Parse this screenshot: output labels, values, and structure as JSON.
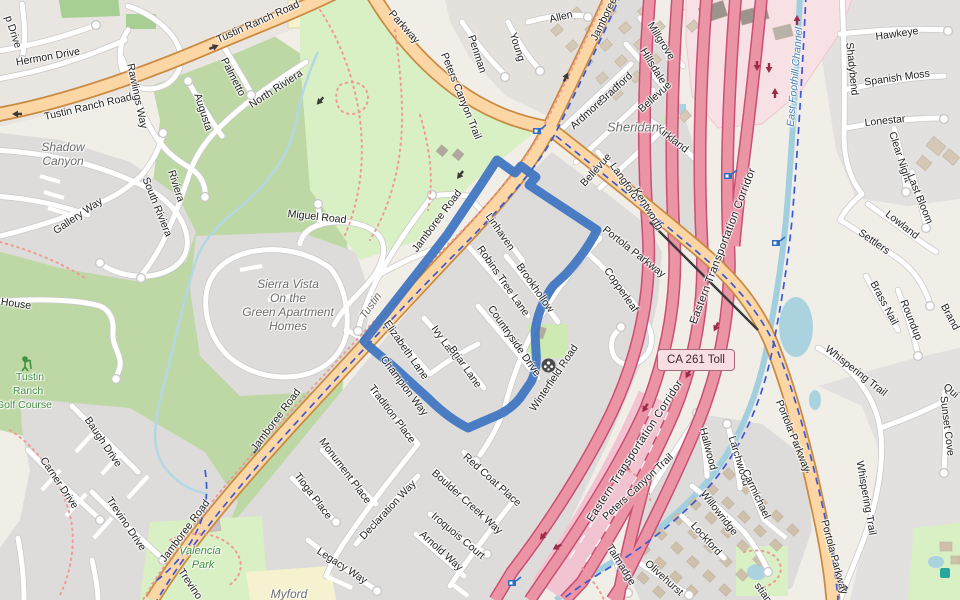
{
  "shield": {
    "text": "CA 261 Toll"
  },
  "route": {
    "color": "#3e74c1"
  },
  "labels": {
    "streets": [
      {
        "t": "Tustin Ranch Road",
        "x": 88,
        "y": 107,
        "r": -13
      },
      {
        "t": "Tustin Ranch Road",
        "x": 258,
        "y": 22,
        "r": -24
      },
      {
        "t": "Parkway",
        "x": 404,
        "y": 27,
        "r": 48
      },
      {
        "t": "Hermon Drive",
        "x": 48,
        "y": 57,
        "r": -10
      },
      {
        "t": "p Drive",
        "x": 13,
        "y": 32,
        "r": 72
      },
      {
        "t": "Rawlings Way",
        "x": 137,
        "y": 96,
        "r": 78
      },
      {
        "t": "Palmetto",
        "x": 233,
        "y": 77,
        "r": 63
      },
      {
        "t": "Augusta",
        "x": 203,
        "y": 112,
        "r": 72
      },
      {
        "t": "North Riviera",
        "x": 276,
        "y": 89,
        "r": -33
      },
      {
        "t": "Riviera",
        "x": 176,
        "y": 186,
        "r": 72
      },
      {
        "t": "South Riviera",
        "x": 157,
        "y": 207,
        "r": 68
      },
      {
        "t": "Gallery Way",
        "x": 78,
        "y": 216,
        "r": -34
      },
      {
        "t": "House",
        "x": 16,
        "y": 304,
        "r": 8
      },
      {
        "t": "Baugh Drive",
        "x": 103,
        "y": 442,
        "r": 56
      },
      {
        "t": "Carner Drive",
        "x": 59,
        "y": 483,
        "r": 56
      },
      {
        "t": "Trevino Drive",
        "x": 126,
        "y": 524,
        "r": 56
      },
      {
        "t": "Trevino",
        "x": 190,
        "y": 584,
        "r": 56
      },
      {
        "t": "Miguel Road",
        "x": 317,
        "y": 217,
        "r": 6
      },
      {
        "t": "Jamboree Road",
        "x": 437,
        "y": 221,
        "r": -53
      },
      {
        "t": "Jamboree Road",
        "x": 276,
        "y": 420,
        "r": -53
      },
      {
        "t": "Jamboree Road",
        "x": 185,
        "y": 531,
        "r": -53
      },
      {
        "t": "Jamboree",
        "x": 604,
        "y": 19,
        "r": -64
      },
      {
        "t": "Portola Parkway",
        "x": 634,
        "y": 252,
        "r": 38
      },
      {
        "t": "Portola Parkway",
        "x": 793,
        "y": 436,
        "r": 68
      },
      {
        "t": "Portola Parkway",
        "x": 834,
        "y": 557,
        "r": 75
      },
      {
        "t": "Linhaven",
        "x": 500,
        "y": 232,
        "r": 55
      },
      {
        "t": "Robins Tree Lane",
        "x": 503,
        "y": 281,
        "r": 55
      },
      {
        "t": "Brookhollow",
        "x": 535,
        "y": 288,
        "r": 55
      },
      {
        "t": "Countryside Drive",
        "x": 514,
        "y": 341,
        "r": 55
      },
      {
        "t": "Winterfield Road",
        "x": 554,
        "y": 378,
        "r": -56
      },
      {
        "t": "Elizabeth Lane",
        "x": 406,
        "y": 350,
        "r": 55
      },
      {
        "t": "Ivy Lane",
        "x": 445,
        "y": 343,
        "r": 55
      },
      {
        "t": "Briar Lane",
        "x": 465,
        "y": 367,
        "r": 55
      },
      {
        "t": "Champion Way",
        "x": 404,
        "y": 386,
        "r": 53
      },
      {
        "t": "Tradition Place",
        "x": 392,
        "y": 414,
        "r": 53
      },
      {
        "t": "Monument Place",
        "x": 345,
        "y": 471,
        "r": 53
      },
      {
        "t": "Tioga Place",
        "x": 313,
        "y": 496,
        "r": 53
      },
      {
        "t": "Declaration Way",
        "x": 388,
        "y": 510,
        "r": -47
      },
      {
        "t": "Legacy Way",
        "x": 342,
        "y": 566,
        "r": 33
      },
      {
        "t": "Boulder Creek Way",
        "x": 467,
        "y": 502,
        "r": 42
      },
      {
        "t": "Red Coat Place",
        "x": 492,
        "y": 480,
        "r": 42
      },
      {
        "t": "Iroquois Court",
        "x": 458,
        "y": 536,
        "r": 40
      },
      {
        "t": "Arnold Way",
        "x": 441,
        "y": 551,
        "r": 42
      },
      {
        "t": "Talmadge",
        "x": 621,
        "y": 565,
        "r": 58
      },
      {
        "t": "Olivehurst",
        "x": 664,
        "y": 578,
        "r": 42
      },
      {
        "t": "Lockford",
        "x": 706,
        "y": 539,
        "r": 48
      },
      {
        "t": "Willowridge",
        "x": 719,
        "y": 513,
        "r": 52
      },
      {
        "t": "Hallwood",
        "x": 708,
        "y": 449,
        "r": 75
      },
      {
        "t": "Larchwood",
        "x": 739,
        "y": 461,
        "r": 73
      },
      {
        "t": "Carmichael",
        "x": 756,
        "y": 494,
        "r": 65
      },
      {
        "t": "Whispering Trail",
        "x": 856,
        "y": 371,
        "r": 38
      },
      {
        "t": "Whispering Trail",
        "x": 866,
        "y": 498,
        "r": 80
      },
      {
        "t": "Sunset Cove",
        "x": 947,
        "y": 426,
        "r": 83
      },
      {
        "t": "Hawkeye",
        "x": 897,
        "y": 34,
        "r": -8
      },
      {
        "t": "Spanish Moss",
        "x": 897,
        "y": 78,
        "r": -8
      },
      {
        "t": "Shadybend",
        "x": 852,
        "y": 69,
        "r": 84
      },
      {
        "t": "Lonestar",
        "x": 885,
        "y": 121,
        "r": -6
      },
      {
        "t": "Clear Night",
        "x": 900,
        "y": 157,
        "r": 72
      },
      {
        "t": "Last Bloom",
        "x": 920,
        "y": 199,
        "r": 68
      },
      {
        "t": "Lowland",
        "x": 902,
        "y": 225,
        "r": 38
      },
      {
        "t": "Settlers",
        "x": 874,
        "y": 242,
        "r": 35
      },
      {
        "t": "Brass Nail",
        "x": 884,
        "y": 303,
        "r": 62
      },
      {
        "t": "Roundup",
        "x": 911,
        "y": 320,
        "r": 68
      },
      {
        "t": "Brand",
        "x": 950,
        "y": 317,
        "r": 62
      },
      {
        "t": "Qui",
        "x": 951,
        "y": 391,
        "r": 40
      },
      {
        "t": "stian",
        "x": 763,
        "y": 593,
        "r": 55
      },
      {
        "t": "Millgrove",
        "x": 661,
        "y": 41,
        "r": 58
      },
      {
        "t": "Hillsdale",
        "x": 653,
        "y": 66,
        "r": 58
      },
      {
        "t": "Bradford",
        "x": 616,
        "y": 88,
        "r": -42
      },
      {
        "t": "Ardmore",
        "x": 587,
        "y": 114,
        "r": -42
      },
      {
        "t": "Bellevue",
        "x": 596,
        "y": 170,
        "r": -48
      },
      {
        "t": "Bellevue",
        "x": 655,
        "y": 97,
        "r": -42
      },
      {
        "t": "Langford",
        "x": 624,
        "y": 181,
        "r": 55
      },
      {
        "t": "Kentworth",
        "x": 648,
        "y": 209,
        "r": 58
      },
      {
        "t": "Kirkland",
        "x": 672,
        "y": 139,
        "r": 38
      },
      {
        "t": "Allen",
        "x": 561,
        "y": 17,
        "r": -14
      },
      {
        "t": "Young",
        "x": 517,
        "y": 47,
        "r": 72
      },
      {
        "t": "Penman",
        "x": 477,
        "y": 54,
        "r": 72
      },
      {
        "t": "Copperleaf",
        "x": 621,
        "y": 290,
        "r": 55
      },
      {
        "t": "Peters Canyon Trail",
        "x": 461,
        "y": 96,
        "r": 68
      },
      {
        "t": "Peters Canyon Trail",
        "x": 638,
        "y": 487,
        "r": -43
      }
    ],
    "corridor": [
      {
        "t": "Eastern Transportation Corridor",
        "x": 723,
        "y": 246,
        "r": -69
      },
      {
        "t": "Eastern Transportation Corridor",
        "x": 635,
        "y": 451,
        "r": -57
      }
    ],
    "places": [
      {
        "t": "Sheridan",
        "x": 633,
        "y": 127,
        "r": 0,
        "s": 13
      },
      {
        "t": "Tustin",
        "x": 371,
        "y": 306,
        "r": -55,
        "s": 11
      },
      {
        "t": "Myford",
        "x": 289,
        "y": 594,
        "r": 0
      },
      {
        "t": "Shadow",
        "x": 63,
        "y": 147,
        "r": 0
      },
      {
        "t": "Canyon",
        "x": 63,
        "y": 161,
        "r": 0
      },
      {
        "t": "Sierra Vista",
        "x": 288,
        "y": 284,
        "r": 0
      },
      {
        "t": "On the",
        "x": 288,
        "y": 298,
        "r": 0
      },
      {
        "t": "Green Apartment",
        "x": 288,
        "y": 312,
        "r": 0
      },
      {
        "t": "Homes",
        "x": 288,
        "y": 326,
        "r": 0
      }
    ],
    "parks": [
      {
        "t": "Tustin",
        "x": 30,
        "y": 377,
        "r": 0
      },
      {
        "t": "Ranch",
        "x": 28,
        "y": 391,
        "r": 0
      },
      {
        "t": "Golf Course",
        "x": 24,
        "y": 405,
        "r": 0
      }
    ],
    "parks_italic": [
      {
        "t": "Valencia",
        "x": 200,
        "y": 551,
        "r": 0
      },
      {
        "t": "Park",
        "x": 203,
        "y": 565,
        "r": 0
      }
    ],
    "water": [
      {
        "t": "East Foothill Channel",
        "x": 795,
        "y": 77,
        "r": -85
      }
    ]
  },
  "icons": [
    {
      "name": "golfer-icon",
      "x": 17,
      "y": 356
    },
    {
      "name": "sports-ball-icon",
      "x": 541,
      "y": 358
    },
    {
      "name": "surveillance-camera-icon",
      "x": 533,
      "y": 124
    },
    {
      "name": "surveillance-camera-icon",
      "x": 724,
      "y": 169
    },
    {
      "name": "surveillance-camera-icon",
      "x": 772,
      "y": 236
    },
    {
      "name": "surveillance-camera-icon",
      "x": 508,
      "y": 576
    },
    {
      "name": "playground-icon",
      "x": 940,
      "y": 568
    }
  ]
}
